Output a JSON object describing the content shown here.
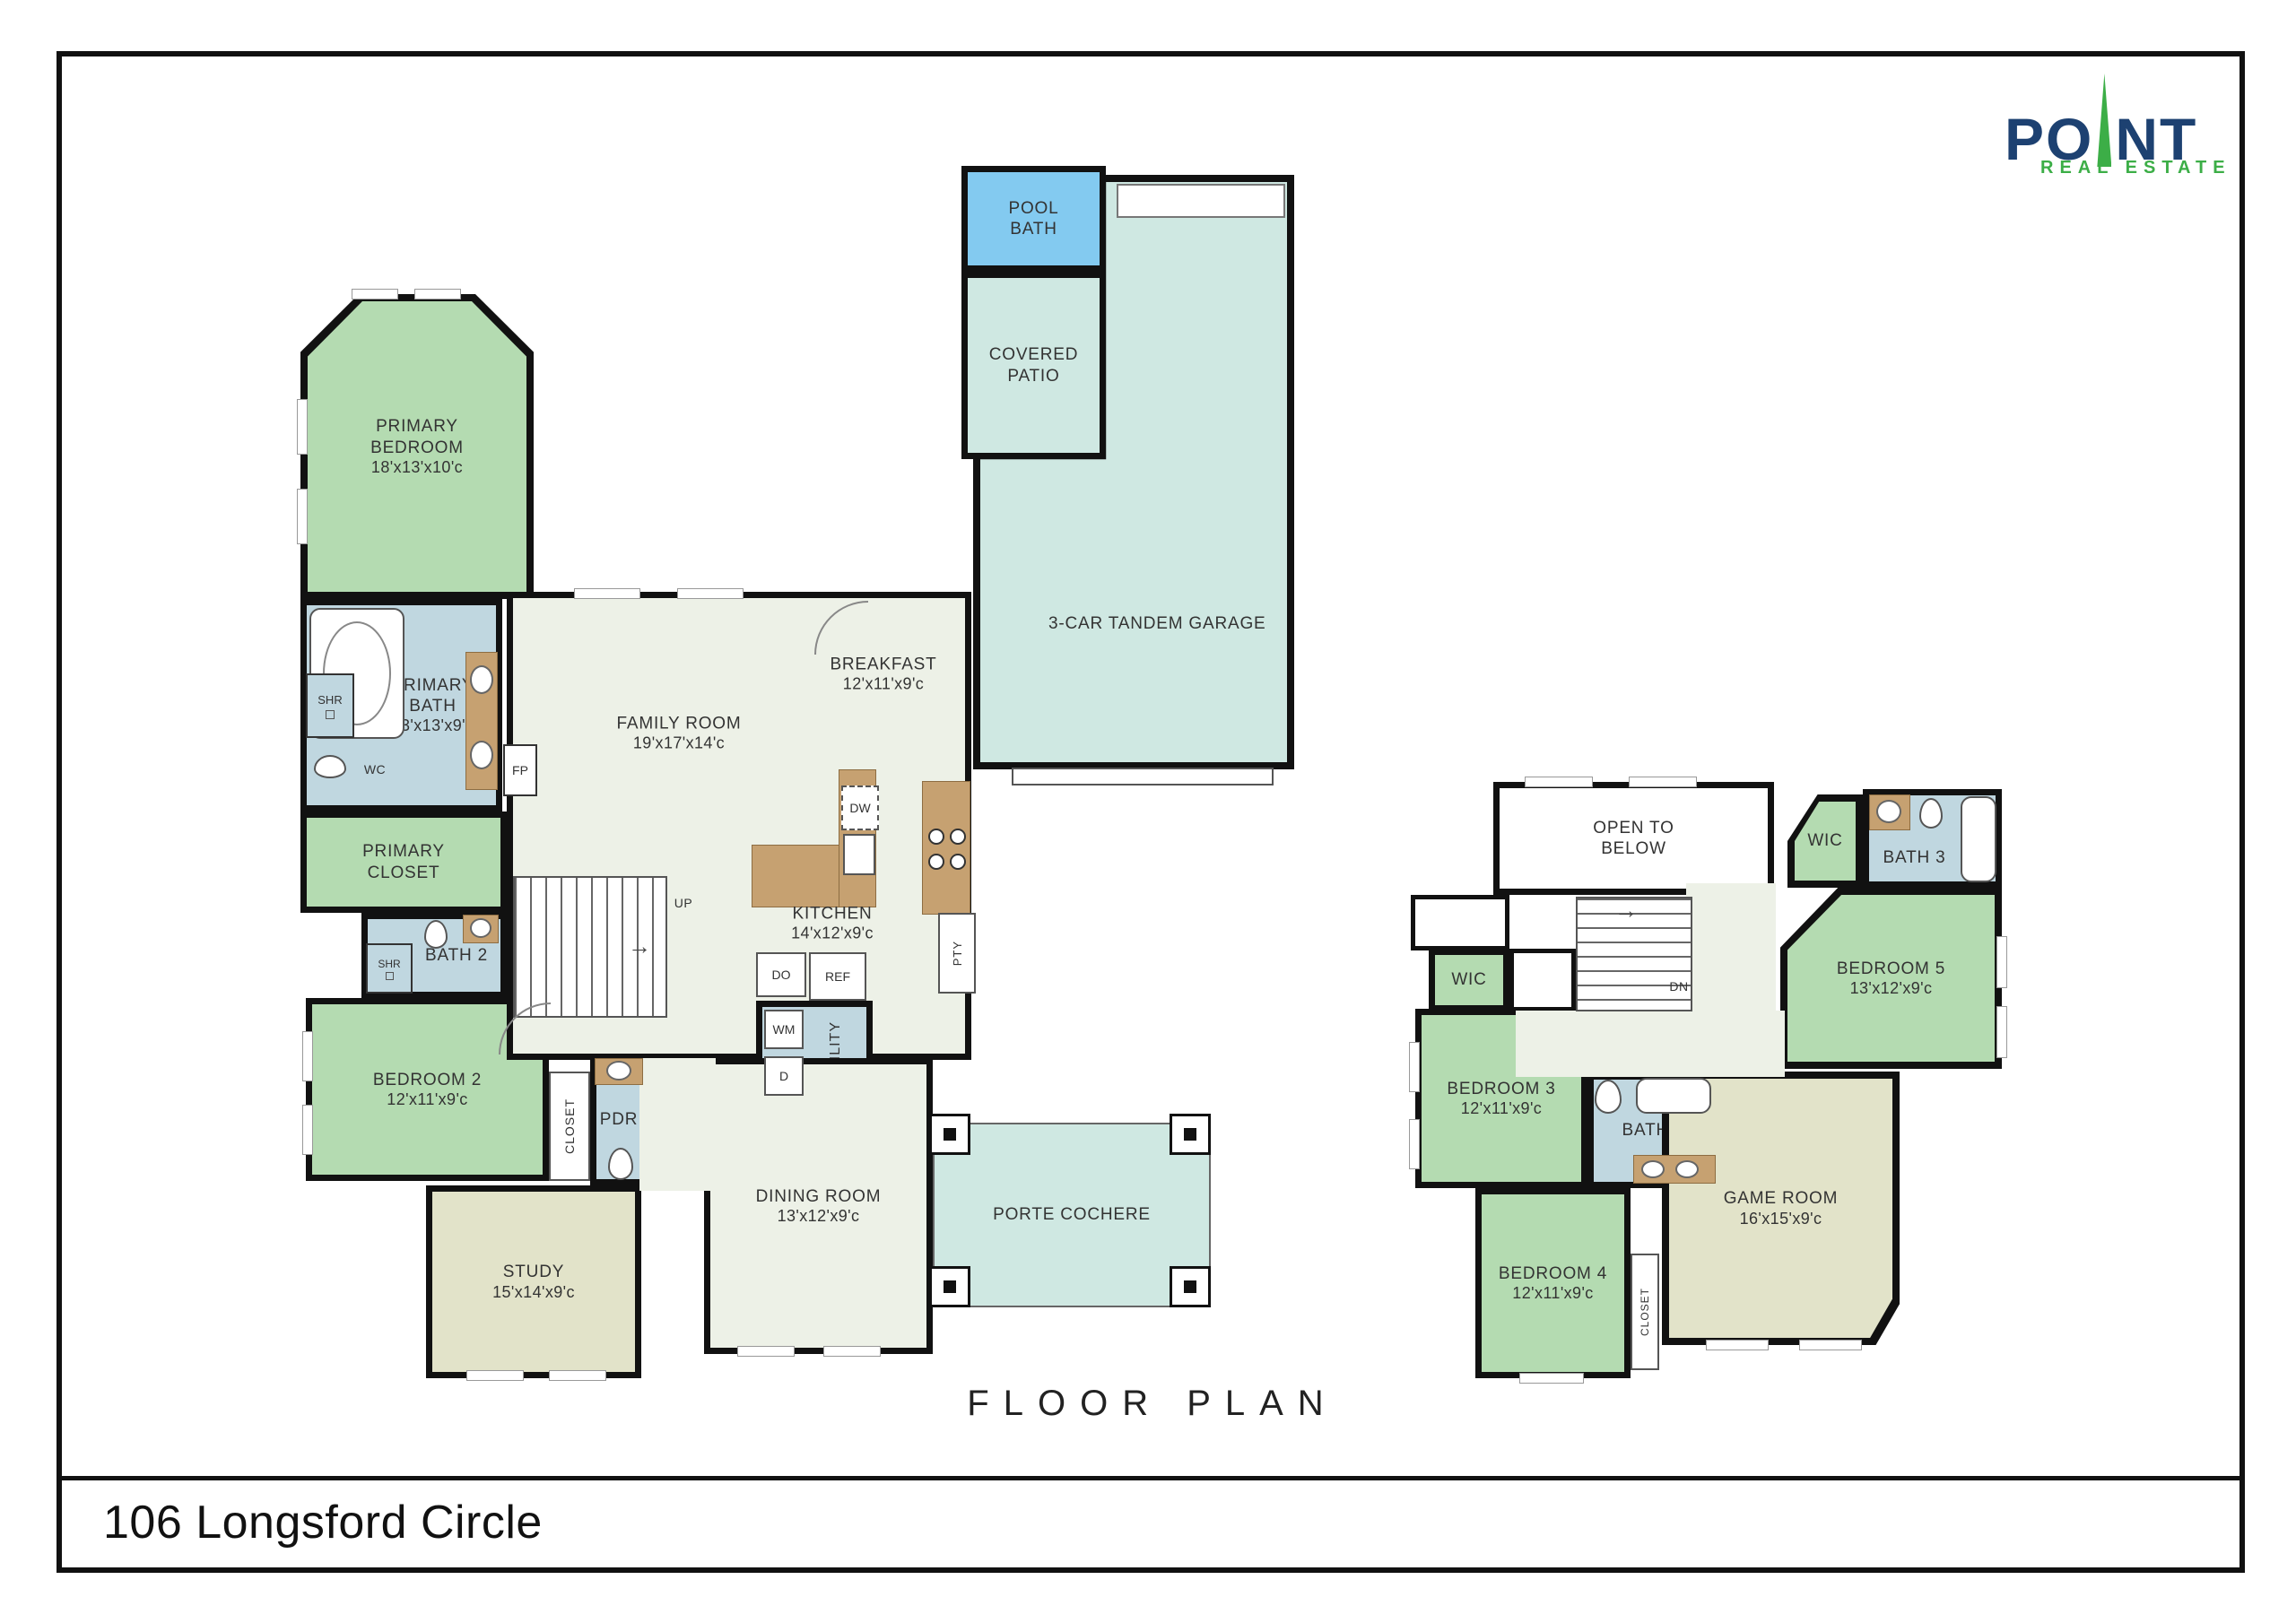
{
  "title_bar": {
    "address": "106 Longsford Circle"
  },
  "plan_caption": "FLOOR PLAN",
  "logo": {
    "brand_left": "PO",
    "brand_right": "NT",
    "tagline": "REAL ESTATE"
  },
  "colors": {
    "bedroom_green": "#b4dbb1",
    "bath_blue": "#c0d7e0",
    "floor_pale": "#edf1e7",
    "outdoor_teal": "#cfe8e2",
    "study_beige": "#e2e3c9",
    "pool_blue": "#83caf0",
    "counter_tan": "#c6a171",
    "wall_black": "#111111",
    "logo_navy": "#1d4171",
    "logo_green": "#3cae47"
  },
  "floor1": {
    "primary_bedroom": {
      "name": "PRIMARY BEDROOM",
      "dims": "18'x13'x10'c"
    },
    "primary_bath": {
      "name": "PRIMARY BATH",
      "dims": "13'x13'x9'c"
    },
    "primary_closet": {
      "name": "PRIMARY CLOSET"
    },
    "bath_2": {
      "name": "BATH 2"
    },
    "bedroom_2": {
      "name": "BEDROOM 2",
      "dims": "12'x11'x9'c"
    },
    "pdr": {
      "name": "PDR"
    },
    "study": {
      "name": "STUDY",
      "dims": "15'x14'x9'c"
    },
    "family_room": {
      "name": "FAMILY ROOM",
      "dims": "19'x17'x14'c"
    },
    "breakfast": {
      "name": "BREAKFAST",
      "dims": "12'x11'x9'c"
    },
    "kitchen": {
      "name": "KITCHEN",
      "dims": "14'x12'x9'c"
    },
    "utility": {
      "name": "UTILITY"
    },
    "dining_room": {
      "name": "DINING ROOM",
      "dims": "13'x12'x9'c"
    },
    "pool_bath": {
      "name": "POOL BATH"
    },
    "covered_patio": {
      "name": "COVERED PATIO"
    },
    "garage": {
      "name": "3-CAR TANDEM GARAGE"
    },
    "porte_cochere": {
      "name": "PORTE COCHERE"
    },
    "fixtures": {
      "shr": "SHR",
      "wc": "WC",
      "fp": "FP",
      "up": "UP",
      "dw": "DW",
      "pty": "PTY",
      "do": "DO",
      "ref": "REF",
      "wm": "WM",
      "d": "D",
      "closet": "CLOSET"
    }
  },
  "floor2": {
    "open_to_below": {
      "name": "OPEN TO BELOW"
    },
    "wic_upper": {
      "name": "WIC"
    },
    "bath_3": {
      "name": "BATH 3"
    },
    "bedroom_5": {
      "name": "BEDROOM 5",
      "dims": "13'x12'x9'c"
    },
    "wic_lower": {
      "name": "WIC"
    },
    "bedroom_3": {
      "name": "BEDROOM 3",
      "dims": "12'x11'x9'c"
    },
    "bath_4": {
      "name": "BATH 4"
    },
    "bedroom_4": {
      "name": "BEDROOM 4",
      "dims": "12'x11'x9'c"
    },
    "game_room": {
      "name": "GAME ROOM",
      "dims": "16'x15'x9'c"
    },
    "closet": {
      "name": "CLOSET"
    },
    "fixtures": {
      "dn": "DN"
    }
  }
}
